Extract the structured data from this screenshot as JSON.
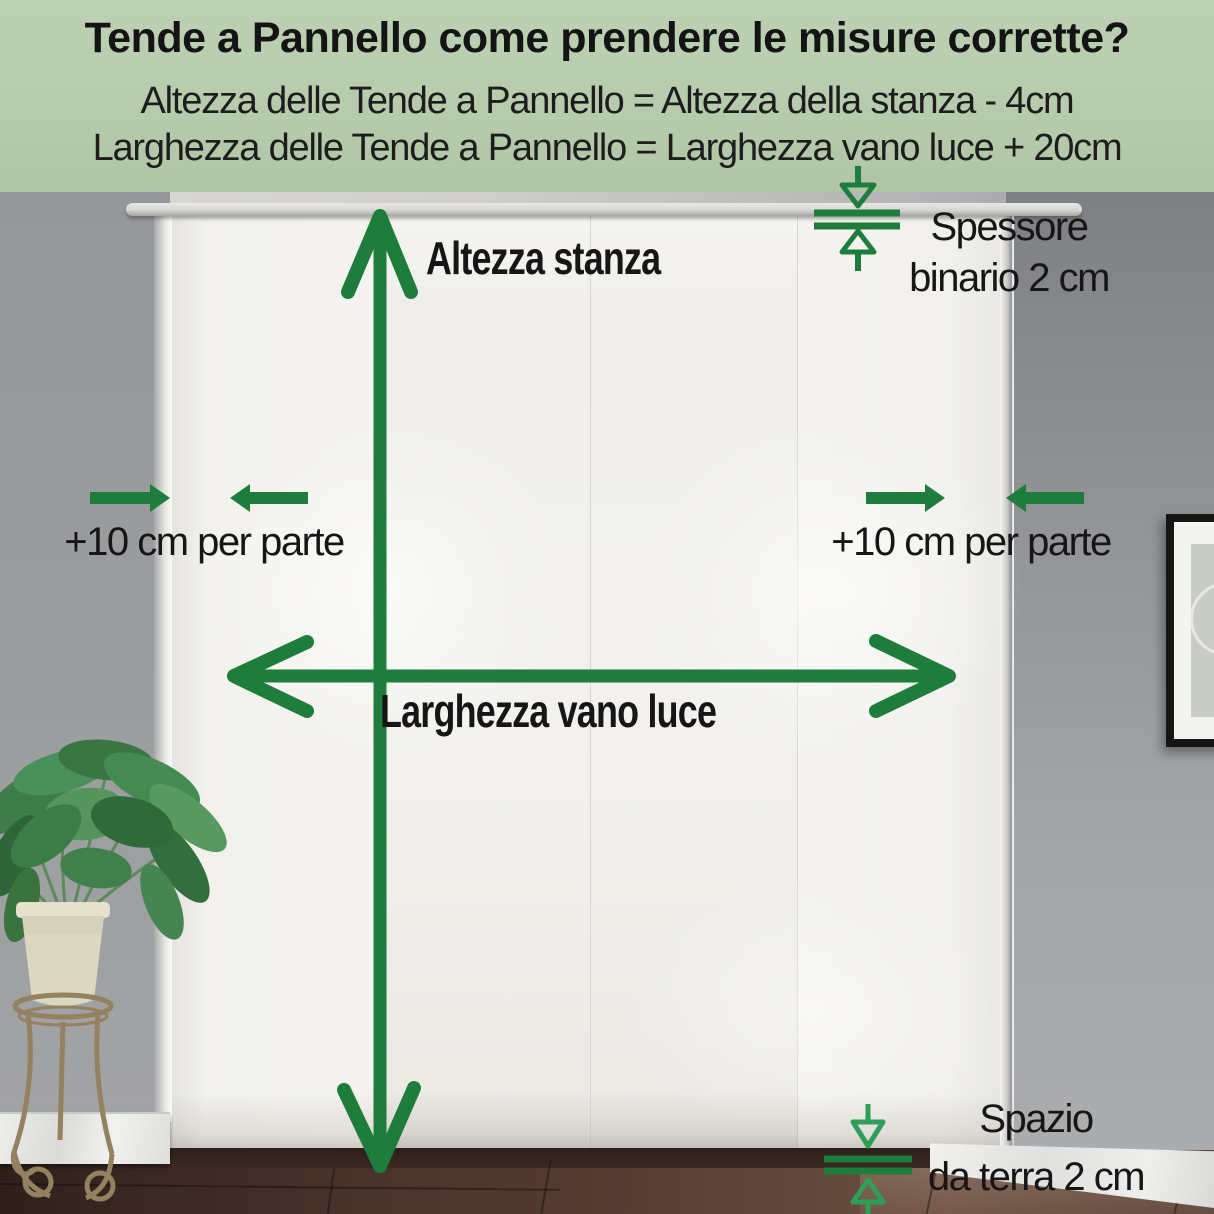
{
  "header": {
    "title": "Tende a Pannello come prendere le misure corrette?",
    "formula_height": "Altezza delle Tende a Pannello = Altezza della stanza - 4cm",
    "formula_width": "Larghezza delle Tende a Pannello = Larghezza vano luce + 20cm"
  },
  "annotations": {
    "room_height_label": "Altezza stanza",
    "opening_width_label": "Larghezza vano luce",
    "left_margin_label": "+10 cm per parte",
    "right_margin_label": "+10 cm per parte",
    "track_thickness_line1": "Spessore",
    "track_thickness_line2": "binario 2 cm",
    "floor_gap_line1": "Spazio",
    "floor_gap_line2": "da terra 2 cm"
  },
  "colors": {
    "accent_green": "#1e7d3c",
    "accent_green_bright": "#2f9e57",
    "header_background": "#b6cbac",
    "text_black": "#1a1a1a"
  }
}
